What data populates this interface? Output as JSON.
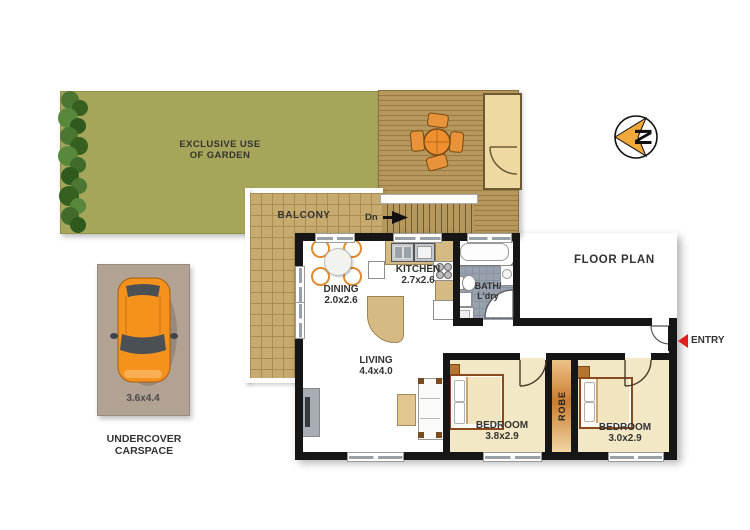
{
  "plan": {
    "title": "FLOOR PLAN",
    "compass_letter": "N",
    "entry_label": "ENTRY",
    "outdoor": {
      "garden_line1": "EXCLUSIVE USE",
      "garden_line2": "OF GARDEN",
      "balcony": "BALCONY",
      "stairs_label": "Dn"
    },
    "rooms": {
      "dining": {
        "name": "DINING",
        "dims": "2.0x2.6"
      },
      "kitchen": {
        "name": "KITCHEN",
        "dims": "2.7x2.6"
      },
      "bath": {
        "name_line1": "BATH/",
        "name_line2": "L'dry"
      },
      "living": {
        "name": "LIVING",
        "dims": "4.4x4.0"
      },
      "bedroom1": {
        "name": "BEDROOM",
        "dims": "3.8x2.9"
      },
      "bedroom2": {
        "name": "BEDROOM",
        "dims": "3.0x2.9"
      },
      "robe": {
        "name": "ROBE"
      }
    },
    "carspace": {
      "dims": "3.6x4.4",
      "label_line1": "UNDERCOVER",
      "label_line2": "CARSPACE"
    },
    "colors": {
      "garden_green": "#a6a65a",
      "deck_timber": "#b6985c",
      "balcony_tile": "#c6aa6e",
      "wall_black": "#161616",
      "bath_tile": "#98a2af",
      "bedroom_floor": "#f3e8c5",
      "robe_orange": "#c87c2e",
      "car_orange": "#f5921e",
      "compass_orange": "#f2a93b",
      "entry_red": "#e01f1f",
      "label_text": "#333333"
    }
  }
}
